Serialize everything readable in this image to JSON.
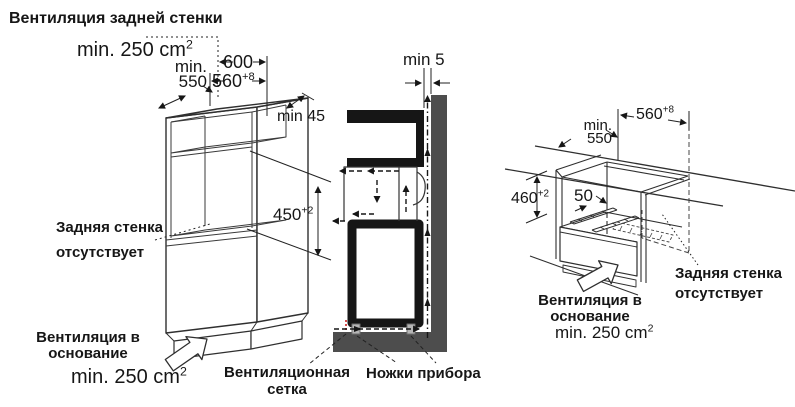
{
  "colors": {
    "line": "#2f2f2f",
    "black_fill": "#161616",
    "wall_gray": "#4d4d4d",
    "feet_gray": "#b5b5b5",
    "vent_grid_red": "#cc2222",
    "background": "#ffffff"
  },
  "left": {
    "title": "Вентиляция задней стенки",
    "vent_top": {
      "base": "min. 250 cm",
      "sup": "2"
    },
    "depth": {
      "line1": "min.",
      "line2": "550"
    },
    "width_outer": "600",
    "width_niche": {
      "base": "560",
      "sup": "+8"
    },
    "top_gap": "min 45",
    "niche_height": {
      "base": "450",
      "sup": "+2"
    },
    "back_wall": {
      "line1": "Задняя стенка",
      "line2": "отсутствует"
    },
    "base_vent": {
      "line1": "Вентиляция в",
      "line2": "основание"
    },
    "vent_bottom": {
      "base": "min. 250 cm",
      "sup": "2"
    }
  },
  "middle": {
    "wall_gap": "min 5",
    "vent_grid": {
      "line1": "Вентиляционная",
      "line2": "сетка"
    },
    "feet": "Ножки прибора"
  },
  "right": {
    "depth": {
      "line1": "min.",
      "line2": "550"
    },
    "width": {
      "base": "560",
      "sup": "+8"
    },
    "height": {
      "base": "460",
      "sup": "+2"
    },
    "spacer": "50",
    "back_wall": {
      "line1": "Задняя стенка",
      "line2": "отсутствует"
    },
    "base_vent": {
      "line1": "Вентиляция в",
      "line2": "основание"
    },
    "vent_bottom": {
      "base": "min. 250 cm",
      "sup": "2"
    }
  }
}
